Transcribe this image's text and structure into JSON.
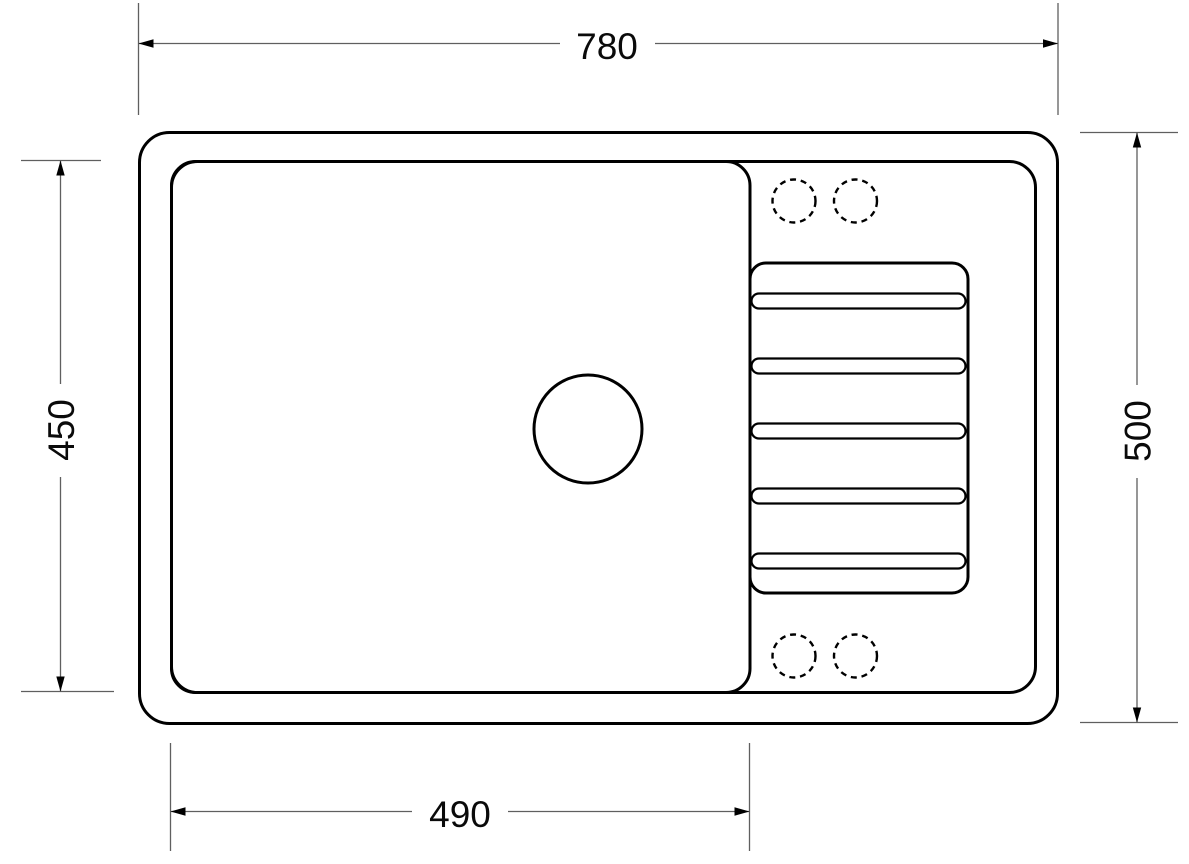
{
  "drawing": {
    "subject": "Kitchen sink with drainboard - top view technical drawing",
    "background_color": "#ffffff",
    "outline_color": "#000000",
    "dimension_line_color": "#5f5f5f",
    "dimension_text_color": "#0a0a0a",
    "dimensions": {
      "overall_width": "780",
      "bowl_depth": "450",
      "overall_depth": "500",
      "bowl_width": "490"
    },
    "features": {
      "tap_hole_count": 4,
      "drainboard_rib_count": 5,
      "drain_hole_count": 1
    }
  }
}
